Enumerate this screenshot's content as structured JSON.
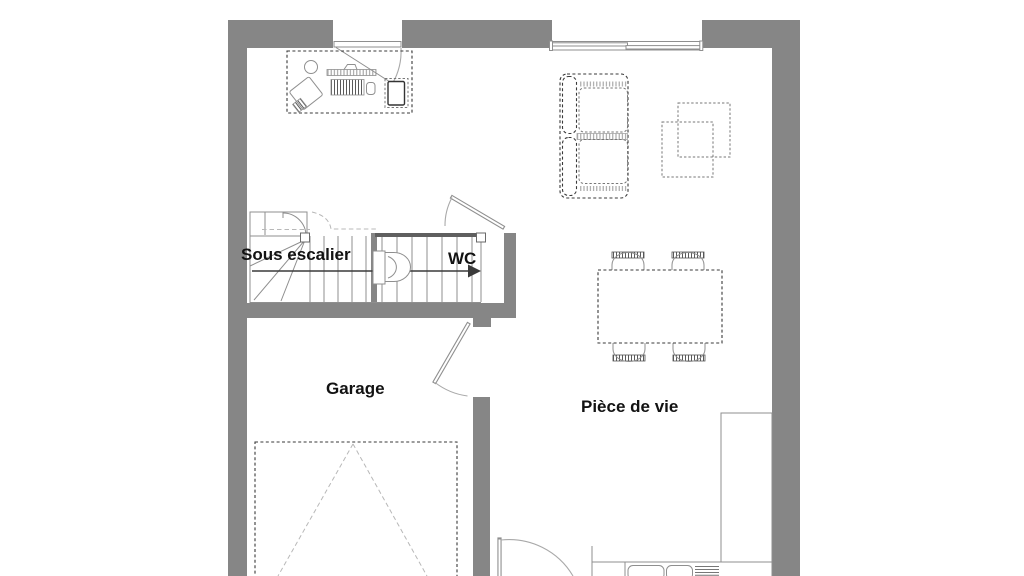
{
  "colors": {
    "bg": "#ffffff",
    "wall": "#868686",
    "wall-dark": "#5f5f5f",
    "line": "#8f8f8f",
    "line-light": "#b8b8b8",
    "furniture": "#3a3a3a",
    "text": "#121212"
  },
  "rooms": {
    "sous_escalier": "Sous escalier",
    "wc": "WC",
    "garage": "Garage",
    "piece_de_vie": "Pièce de vie"
  }
}
